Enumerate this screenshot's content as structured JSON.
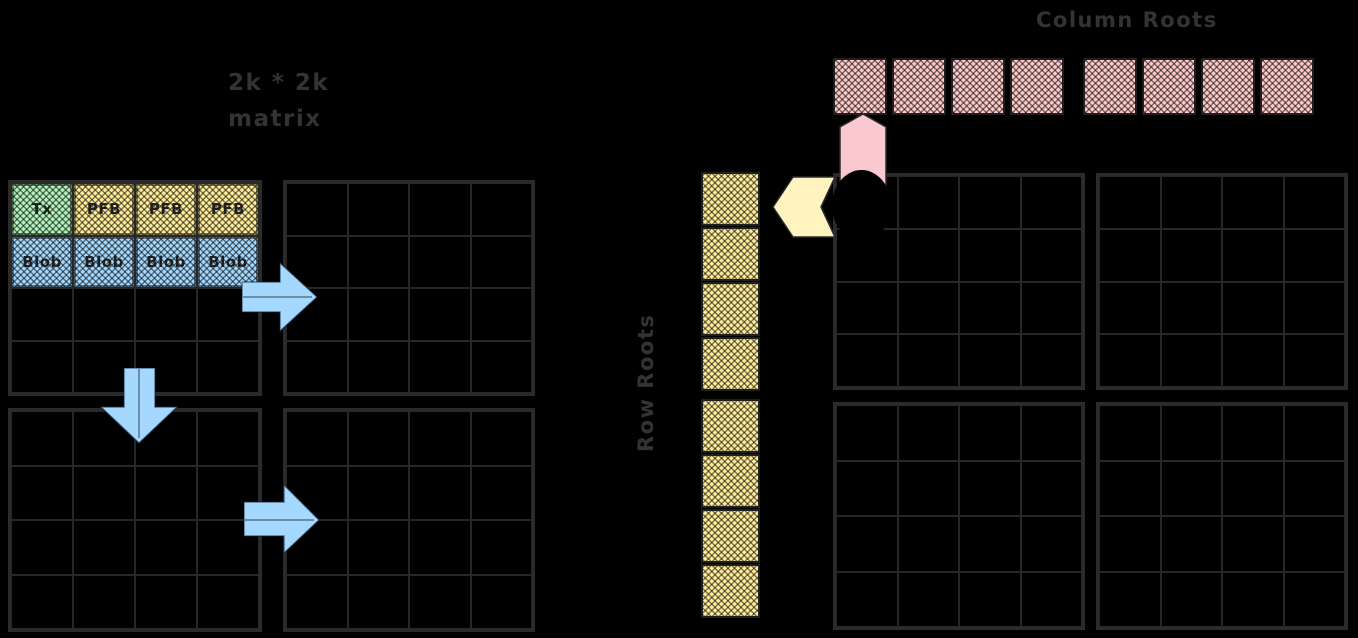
{
  "colors": {
    "background": "#000000",
    "stroke": "#2b2b2b",
    "label_text": "#333333",
    "cell_text": "#1e1e1e",
    "green": "#b2f2bb",
    "yellow": "#ffec99",
    "blue": "#a5d8ff",
    "pink": "#ffc9c9",
    "yellow_arrow": "#fff3bf",
    "pink_arrow": "#fac9cf"
  },
  "left_matrix": {
    "title_line1": "2k * 2k",
    "title_line2": "matrix",
    "grid_rows": 4,
    "grid_cols": 4,
    "row1_cells": [
      {
        "label": "Tx",
        "fill": "green"
      },
      {
        "label": "PFB",
        "fill": "yellow"
      },
      {
        "label": "PFB",
        "fill": "yellow"
      },
      {
        "label": "PFB",
        "fill": "yellow"
      }
    ],
    "row2_cells": [
      {
        "label": "Blob",
        "fill": "blue"
      },
      {
        "label": "Blob",
        "fill": "blue"
      },
      {
        "label": "Blob",
        "fill": "blue"
      },
      {
        "label": "Blob",
        "fill": "blue"
      }
    ]
  },
  "right_matrix": {
    "grid_rows": 4,
    "grid_cols": 4
  },
  "column_roots": {
    "label": "Column Roots",
    "count": 8,
    "group_size": 4,
    "fill": "pink"
  },
  "row_roots": {
    "label": "Row Roots",
    "count": 8,
    "group_size": 4,
    "fill": "yellow"
  }
}
